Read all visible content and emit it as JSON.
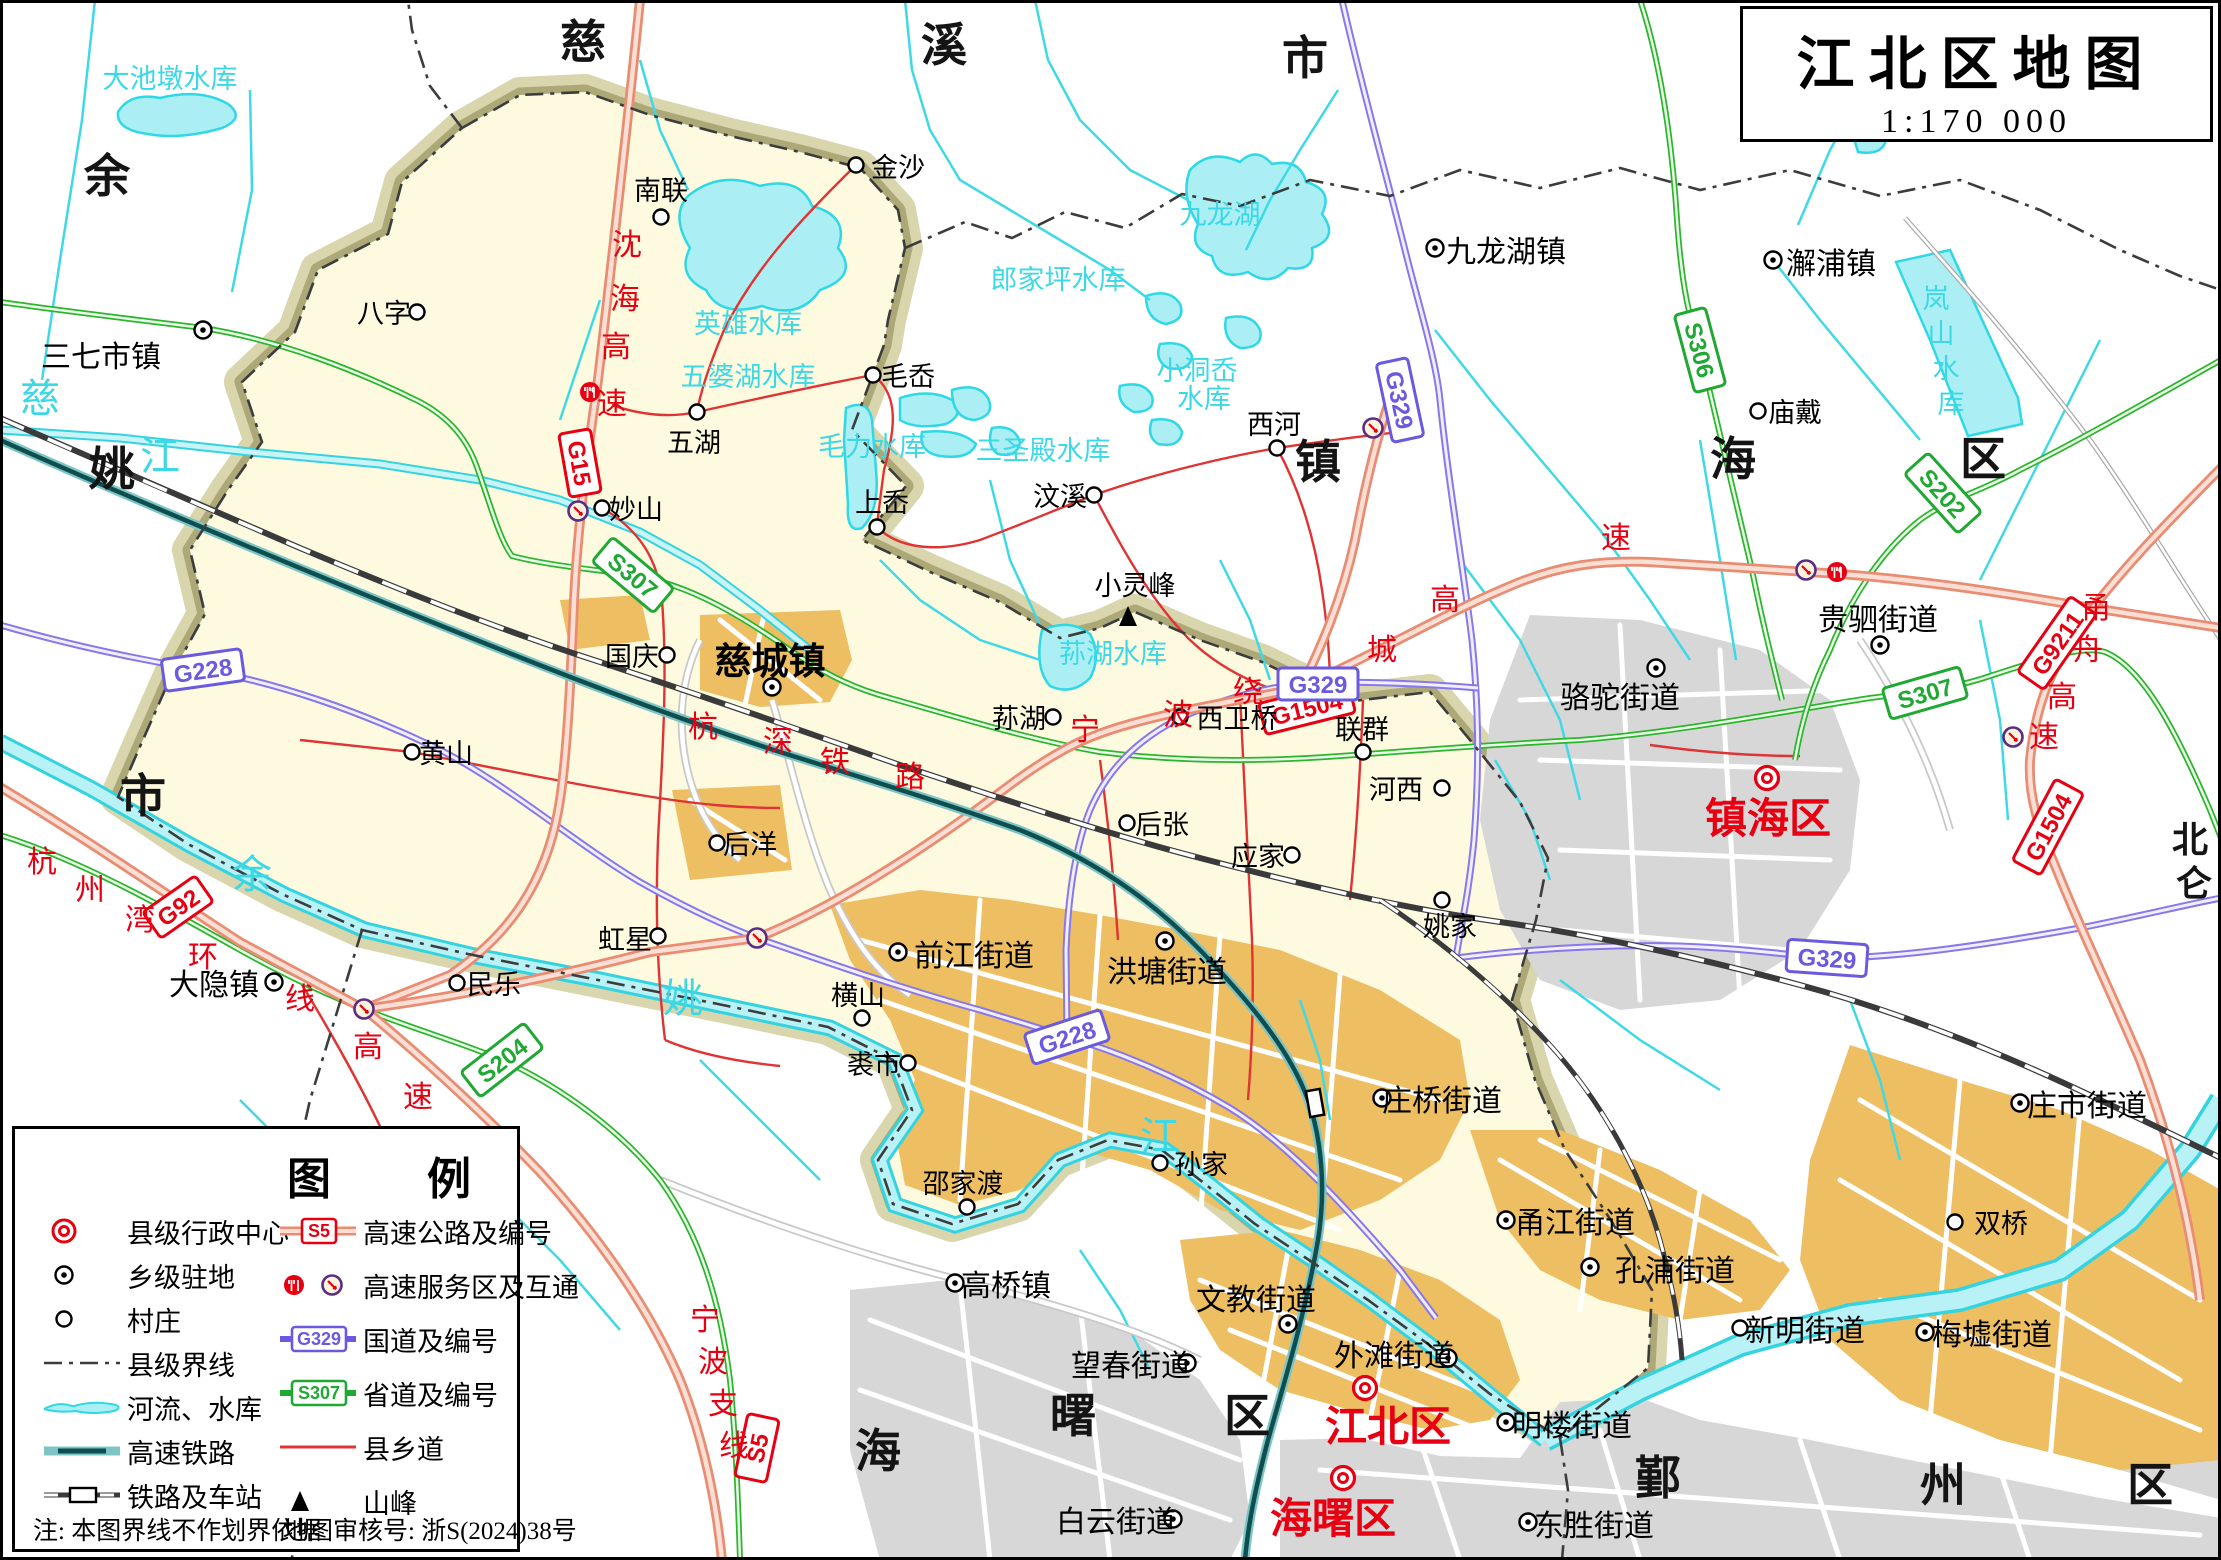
{
  "title": {
    "name": "江北区地图",
    "scale": "1:170 000"
  },
  "legend": {
    "header_left": "图",
    "header_right": "例",
    "note": "注:  本图界线不作划界依据",
    "review": "地图审核号:  浙S(2024)38号",
    "left_items": [
      {
        "icon": "county-center-icon",
        "label": "县级行政中心"
      },
      {
        "icon": "town-seat-icon",
        "label": "乡级驻地"
      },
      {
        "icon": "village-icon",
        "label": "村庄"
      },
      {
        "icon": "county-boundary-icon",
        "label": "县级界线"
      },
      {
        "icon": "river-reservoir-icon",
        "label": "河流、水库"
      },
      {
        "icon": "hsr-icon",
        "label": "高速铁路"
      },
      {
        "icon": "railway-station-icon",
        "label": "铁路及车站"
      }
    ],
    "right_items": [
      {
        "icon": "expressway-badge-icon",
        "label": "高速公路及编号"
      },
      {
        "icon": "service-interchange-icon",
        "label": "高速服务区及互通"
      },
      {
        "icon": "national-road-badge-icon",
        "label": "国道及编号"
      },
      {
        "icon": "provincial-road-badge-icon",
        "label": "省道及编号"
      },
      {
        "icon": "county-road-icon",
        "label": "县乡道"
      },
      {
        "icon": "peak-icon",
        "label": "山峰"
      }
    ]
  },
  "map": {
    "labels": [
      {
        "t": "慈",
        "x": 583,
        "y": 58,
        "c": "big"
      },
      {
        "t": "溪",
        "x": 944,
        "y": 61,
        "c": "big"
      },
      {
        "t": "市",
        "x": 1305,
        "y": 74,
        "c": "big"
      },
      {
        "t": "余",
        "x": 107,
        "y": 192,
        "c": "big"
      },
      {
        "t": "姚",
        "x": 112,
        "y": 485,
        "c": "big"
      },
      {
        "t": "市",
        "x": 143,
        "y": 812,
        "c": "big"
      },
      {
        "t": "镇",
        "x": 1318,
        "y": 478,
        "c": "big"
      },
      {
        "t": "海",
        "x": 1733,
        "y": 475,
        "c": "big"
      },
      {
        "t": "区",
        "x": 1983,
        "y": 475,
        "c": "big"
      },
      {
        "t": "海",
        "x": 878,
        "y": 1467,
        "c": "big"
      },
      {
        "t": "曙",
        "x": 1073,
        "y": 1432,
        "c": "big"
      },
      {
        "t": "区",
        "x": 1247,
        "y": 1432,
        "c": "big"
      },
      {
        "t": "鄞",
        "x": 1658,
        "y": 1494,
        "c": "big"
      },
      {
        "t": "州",
        "x": 1943,
        "y": 1501,
        "c": "big"
      },
      {
        "t": "区",
        "x": 2150,
        "y": 1501,
        "c": "big"
      },
      {
        "t": "北",
        "x": 2190,
        "y": 852,
        "c": "big2"
      },
      {
        "t": "仑",
        "x": 2194,
        "y": 896,
        "c": "big2"
      },
      {
        "t": "大池墩水库",
        "x": 170,
        "y": 88,
        "c": "water"
      },
      {
        "t": "英雄水库",
        "x": 748,
        "y": 333,
        "c": "water"
      },
      {
        "t": "五婆湖水库",
        "x": 748,
        "y": 386,
        "c": "water"
      },
      {
        "t": "毛力水库",
        "x": 872,
        "y": 456,
        "c": "water"
      },
      {
        "t": "三圣殿水库",
        "x": 1043,
        "y": 460,
        "c": "water"
      },
      {
        "t": "郎家坪水库",
        "x": 1058,
        "y": 289,
        "c": "water"
      },
      {
        "t": "小洞岙",
        "x": 1197,
        "y": 380,
        "c": "water"
      },
      {
        "t": "水库",
        "x": 1204,
        "y": 408,
        "c": "water"
      },
      {
        "t": "九龙湖",
        "x": 1220,
        "y": 224,
        "c": "water"
      },
      {
        "t": "荪湖水库",
        "x": 1113,
        "y": 663,
        "c": "water"
      },
      {
        "t": "岚",
        "x": 1936,
        "y": 308,
        "c": "water"
      },
      {
        "t": "山",
        "x": 1941,
        "y": 343,
        "c": "water"
      },
      {
        "t": "水",
        "x": 1946,
        "y": 378,
        "c": "water"
      },
      {
        "t": "库",
        "x": 1951,
        "y": 413,
        "c": "water"
      },
      {
        "t": "慈",
        "x": 40,
        "y": 412,
        "c": "waterbig"
      },
      {
        "t": "江",
        "x": 160,
        "y": 470,
        "c": "waterbig"
      },
      {
        "t": "余",
        "x": 252,
        "y": 888,
        "c": "waterbig"
      },
      {
        "t": "姚",
        "x": 683,
        "y": 1012,
        "c": "waterbig"
      },
      {
        "t": "江",
        "x": 1160,
        "y": 1150,
        "c": "waterbig"
      },
      {
        "t": "沈",
        "x": 627,
        "y": 255,
        "c": "road"
      },
      {
        "t": "海",
        "x": 625,
        "y": 309,
        "c": "road"
      },
      {
        "t": "高",
        "x": 616,
        "y": 357,
        "c": "road"
      },
      {
        "t": "速",
        "x": 612,
        "y": 414,
        "c": "road"
      },
      {
        "t": "杭",
        "x": 42,
        "y": 872,
        "c": "road"
      },
      {
        "t": "州",
        "x": 90,
        "y": 900,
        "c": "road"
      },
      {
        "t": "湾",
        "x": 140,
        "y": 930,
        "c": "road"
      },
      {
        "t": "环",
        "x": 203,
        "y": 967,
        "c": "road"
      },
      {
        "t": "线",
        "x": 300,
        "y": 1009,
        "c": "road"
      },
      {
        "t": "高",
        "x": 368,
        "y": 1057,
        "c": "road"
      },
      {
        "t": "速",
        "x": 418,
        "y": 1107,
        "c": "road"
      },
      {
        "t": "宁",
        "x": 1085,
        "y": 740,
        "c": "road"
      },
      {
        "t": "波",
        "x": 1178,
        "y": 725,
        "c": "road"
      },
      {
        "t": "绕",
        "x": 1248,
        "y": 702,
        "c": "road"
      },
      {
        "t": "城",
        "x": 1382,
        "y": 660,
        "c": "road"
      },
      {
        "t": "高",
        "x": 1445,
        "y": 610,
        "c": "road"
      },
      {
        "t": "速",
        "x": 1616,
        "y": 548,
        "c": "road"
      },
      {
        "t": "甬",
        "x": 2096,
        "y": 618,
        "c": "road"
      },
      {
        "t": "舟",
        "x": 2088,
        "y": 660,
        "c": "road"
      },
      {
        "t": "高",
        "x": 2062,
        "y": 707,
        "c": "road"
      },
      {
        "t": "速",
        "x": 2044,
        "y": 747,
        "c": "road"
      },
      {
        "t": "宁",
        "x": 705,
        "y": 1330,
        "c": "road"
      },
      {
        "t": "波",
        "x": 713,
        "y": 1372,
        "c": "road"
      },
      {
        "t": "支",
        "x": 723,
        "y": 1414,
        "c": "road"
      },
      {
        "t": "线",
        "x": 734,
        "y": 1456,
        "c": "road"
      },
      {
        "t": "杭",
        "x": 703,
        "y": 737,
        "c": "road"
      },
      {
        "t": "深",
        "x": 778,
        "y": 752,
        "c": "road"
      },
      {
        "t": "铁",
        "x": 835,
        "y": 772,
        "c": "road"
      },
      {
        "t": "路",
        "x": 910,
        "y": 787,
        "c": "road"
      },
      {
        "t": "南联",
        "x": 661,
        "y": 200,
        "c": "vil"
      },
      {
        "t": "金沙",
        "x": 898,
        "y": 177,
        "c": "vil"
      },
      {
        "t": "八字",
        "x": 384,
        "y": 323,
        "c": "vil"
      },
      {
        "t": "妙山",
        "x": 636,
        "y": 519,
        "c": "vil"
      },
      {
        "t": "五湖",
        "x": 694,
        "y": 452,
        "c": "vil"
      },
      {
        "t": "毛岙",
        "x": 908,
        "y": 386,
        "c": "vil"
      },
      {
        "t": "上岙",
        "x": 882,
        "y": 512,
        "c": "vil"
      },
      {
        "t": "国庆",
        "x": 632,
        "y": 666,
        "c": "vil"
      },
      {
        "t": "汶溪",
        "x": 1060,
        "y": 506,
        "c": "vil"
      },
      {
        "t": "西河",
        "x": 1274,
        "y": 434,
        "c": "vil"
      },
      {
        "t": "庙戴",
        "x": 1795,
        "y": 422,
        "c": "vil"
      },
      {
        "t": "黄山",
        "x": 446,
        "y": 763,
        "c": "vil"
      },
      {
        "t": "后洋",
        "x": 750,
        "y": 854,
        "c": "vil"
      },
      {
        "t": "虹星",
        "x": 625,
        "y": 949,
        "c": "vil"
      },
      {
        "t": "民乐",
        "x": 494,
        "y": 994,
        "c": "vil"
      },
      {
        "t": "荪湖",
        "x": 1019,
        "y": 728,
        "c": "vil"
      },
      {
        "t": "后张",
        "x": 1162,
        "y": 834,
        "c": "vil"
      },
      {
        "t": "应家",
        "x": 1258,
        "y": 866,
        "c": "vil"
      },
      {
        "t": "联群",
        "x": 1362,
        "y": 739,
        "c": "vil"
      },
      {
        "t": "姚家",
        "x": 1450,
        "y": 936,
        "c": "vil"
      },
      {
        "t": "西卫桥",
        "x": 1237,
        "y": 728,
        "c": "vil"
      },
      {
        "t": "河西",
        "x": 1396,
        "y": 799,
        "c": "vil"
      },
      {
        "t": "双桥",
        "x": 2001,
        "y": 1233,
        "c": "vil"
      },
      {
        "t": "横山",
        "x": 858,
        "y": 1005,
        "c": "vil"
      },
      {
        "t": "裘市",
        "x": 874,
        "y": 1074,
        "c": "vil"
      },
      {
        "t": "孙家",
        "x": 1201,
        "y": 1174,
        "c": "vil"
      },
      {
        "t": "邵家渡",
        "x": 963,
        "y": 1193,
        "c": "vil"
      },
      {
        "t": "小灵峰",
        "x": 1135,
        "y": 595,
        "c": "vil"
      },
      {
        "t": "三七市镇",
        "x": 101,
        "y": 367,
        "c": "town"
      },
      {
        "t": "大隐镇",
        "x": 214,
        "y": 995,
        "c": "town"
      },
      {
        "t": "九龙湖镇",
        "x": 1506,
        "y": 262,
        "c": "town"
      },
      {
        "t": "澥浦镇",
        "x": 1831,
        "y": 274,
        "c": "town"
      },
      {
        "t": "高桥镇",
        "x": 1006,
        "y": 1296,
        "c": "town"
      },
      {
        "t": "骆驼街道",
        "x": 1620,
        "y": 708,
        "c": "town"
      },
      {
        "t": "贵驷街道",
        "x": 1878,
        "y": 630,
        "c": "town"
      },
      {
        "t": "前江街道",
        "x": 974,
        "y": 966,
        "c": "town"
      },
      {
        "t": "洪塘街道",
        "x": 1167,
        "y": 982,
        "c": "town"
      },
      {
        "t": "庄桥街道",
        "x": 1442,
        "y": 1111,
        "c": "town"
      },
      {
        "t": "文教街道",
        "x": 1256,
        "y": 1310,
        "c": "town"
      },
      {
        "t": "外滩街道",
        "x": 1394,
        "y": 1366,
        "c": "town"
      },
      {
        "t": "望春街道",
        "x": 1131,
        "y": 1376,
        "c": "town"
      },
      {
        "t": "白云街道",
        "x": 1116,
        "y": 1532,
        "c": "town"
      },
      {
        "t": "甬江街道",
        "x": 1575,
        "y": 1233,
        "c": "town"
      },
      {
        "t": "孔浦街道",
        "x": 1675,
        "y": 1281,
        "c": "town"
      },
      {
        "t": "明楼街道",
        "x": 1572,
        "y": 1436,
        "c": "town"
      },
      {
        "t": "东胜街道",
        "x": 1594,
        "y": 1536,
        "c": "town"
      },
      {
        "t": "新明街道",
        "x": 1805,
        "y": 1341,
        "c": "town"
      },
      {
        "t": "梅墟街道",
        "x": 1992,
        "y": 1345,
        "c": "town"
      },
      {
        "t": "庄市街道",
        "x": 2087,
        "y": 1116,
        "c": "town"
      },
      {
        "t": "慈城镇",
        "x": 770,
        "y": 674,
        "c": "czh"
      },
      {
        "t": "镇海区",
        "x": 1768,
        "y": 833,
        "c": "adm"
      },
      {
        "t": "江北区",
        "x": 1388,
        "y": 1441,
        "c": "adm"
      },
      {
        "t": "海曙区",
        "x": 1333,
        "y": 1533,
        "c": "adm"
      }
    ],
    "symbols": [
      {
        "k": "v",
        "x": 661,
        "y": 217
      },
      {
        "k": "v",
        "x": 856,
        "y": 165
      },
      {
        "k": "v",
        "x": 417,
        "y": 312
      },
      {
        "k": "v",
        "x": 602,
        "y": 508
      },
      {
        "k": "v",
        "x": 697,
        "y": 412
      },
      {
        "k": "v",
        "x": 873,
        "y": 375
      },
      {
        "k": "v",
        "x": 877,
        "y": 527
      },
      {
        "k": "v",
        "x": 667,
        "y": 655
      },
      {
        "k": "v",
        "x": 1094,
        "y": 495
      },
      {
        "k": "v",
        "x": 1277,
        "y": 448
      },
      {
        "k": "v",
        "x": 1758,
        "y": 411
      },
      {
        "k": "v",
        "x": 412,
        "y": 752
      },
      {
        "k": "v",
        "x": 717,
        "y": 843
      },
      {
        "k": "v",
        "x": 658,
        "y": 936
      },
      {
        "k": "v",
        "x": 457,
        "y": 983
      },
      {
        "k": "v",
        "x": 1053,
        "y": 717
      },
      {
        "k": "v",
        "x": 1127,
        "y": 823
      },
      {
        "k": "v",
        "x": 1292,
        "y": 855
      },
      {
        "k": "v",
        "x": 1363,
        "y": 752
      },
      {
        "k": "v",
        "x": 1442,
        "y": 900
      },
      {
        "k": "v",
        "x": 1180,
        "y": 717
      },
      {
        "k": "v",
        "x": 1442,
        "y": 788
      },
      {
        "k": "v",
        "x": 1955,
        "y": 1222
      },
      {
        "k": "v",
        "x": 862,
        "y": 1018
      },
      {
        "k": "v",
        "x": 908,
        "y": 1063
      },
      {
        "k": "v",
        "x": 1160,
        "y": 1163
      },
      {
        "k": "v",
        "x": 967,
        "y": 1207
      },
      {
        "k": "v",
        "x": 1740,
        "y": 1328
      },
      {
        "k": "t",
        "x": 203,
        "y": 330
      },
      {
        "k": "t",
        "x": 274,
        "y": 982
      },
      {
        "k": "t",
        "x": 772,
        "y": 687
      },
      {
        "k": "t",
        "x": 1435,
        "y": 248
      },
      {
        "k": "t",
        "x": 1773,
        "y": 260
      },
      {
        "k": "t",
        "x": 955,
        "y": 1283
      },
      {
        "k": "t",
        "x": 1656,
        "y": 668
      },
      {
        "k": "t",
        "x": 1880,
        "y": 645
      },
      {
        "k": "t",
        "x": 898,
        "y": 952
      },
      {
        "k": "t",
        "x": 1165,
        "y": 941
      },
      {
        "k": "t",
        "x": 1382,
        "y": 1098
      },
      {
        "k": "t",
        "x": 1288,
        "y": 1324
      },
      {
        "k": "t",
        "x": 1448,
        "y": 1358
      },
      {
        "k": "t",
        "x": 1187,
        "y": 1363
      },
      {
        "k": "t",
        "x": 1173,
        "y": 1519
      },
      {
        "k": "t",
        "x": 1506,
        "y": 1220
      },
      {
        "k": "t",
        "x": 1590,
        "y": 1267
      },
      {
        "k": "t",
        "x": 1506,
        "y": 1422
      },
      {
        "k": "t",
        "x": 1528,
        "y": 1522
      },
      {
        "k": "t",
        "x": 1925,
        "y": 1332
      },
      {
        "k": "t",
        "x": 2020,
        "y": 1103
      },
      {
        "k": "c",
        "x": 1767,
        "y": 778
      },
      {
        "k": "c",
        "x": 1365,
        "y": 1388
      },
      {
        "k": "c",
        "x": 1343,
        "y": 1478
      },
      {
        "k": "p",
        "x": 1128,
        "y": 618
      },
      {
        "k": "s",
        "x": 590,
        "y": 392
      },
      {
        "k": "s",
        "x": 1837,
        "y": 572
      },
      {
        "k": "i",
        "x": 578,
        "y": 511
      },
      {
        "k": "i",
        "x": 364,
        "y": 1009
      },
      {
        "k": "i",
        "x": 757,
        "y": 938
      },
      {
        "k": "i",
        "x": 1373,
        "y": 428
      },
      {
        "k": "i",
        "x": 1806,
        "y": 570
      },
      {
        "k": "i",
        "x": 2013,
        "y": 737
      },
      {
        "k": "st",
        "x": 1315,
        "y": 1103,
        "r": 80
      }
    ],
    "badges": [
      {
        "code": "G15",
        "kind": "e",
        "x": 580,
        "y": 463,
        "r": 80
      },
      {
        "code": "G92",
        "kind": "e",
        "x": 178,
        "y": 907,
        "r": -35
      },
      {
        "code": "G1504",
        "kind": "e",
        "x": 1307,
        "y": 708,
        "r": -14
      },
      {
        "code": "G1504",
        "kind": "e",
        "x": 2048,
        "y": 827,
        "r": -62
      },
      {
        "code": "G9211",
        "kind": "e",
        "x": 2057,
        "y": 643,
        "r": -55
      },
      {
        "code": "S5",
        "kind": "e",
        "x": 757,
        "y": 1448,
        "r": -78
      },
      {
        "code": "G228",
        "kind": "n",
        "x": 203,
        "y": 670,
        "r": -8
      },
      {
        "code": "G228",
        "kind": "n",
        "x": 1067,
        "y": 1037,
        "r": -18
      },
      {
        "code": "G329",
        "kind": "n",
        "x": 1400,
        "y": 400,
        "r": 78
      },
      {
        "code": "G329",
        "kind": "n",
        "x": 1318,
        "y": 684,
        "r": 0
      },
      {
        "code": "G329",
        "kind": "n",
        "x": 1827,
        "y": 958,
        "r": 4
      },
      {
        "code": "S307",
        "kind": "p",
        "x": 633,
        "y": 575,
        "r": 40
      },
      {
        "code": "S307",
        "kind": "p",
        "x": 1925,
        "y": 693,
        "r": -16
      },
      {
        "code": "S306",
        "kind": "p",
        "x": 1700,
        "y": 350,
        "r": 75
      },
      {
        "code": "S202",
        "kind": "p",
        "x": 1943,
        "y": 493,
        "r": 48
      },
      {
        "code": "S204",
        "kind": "p",
        "x": 502,
        "y": 1060,
        "r": -38
      }
    ]
  }
}
